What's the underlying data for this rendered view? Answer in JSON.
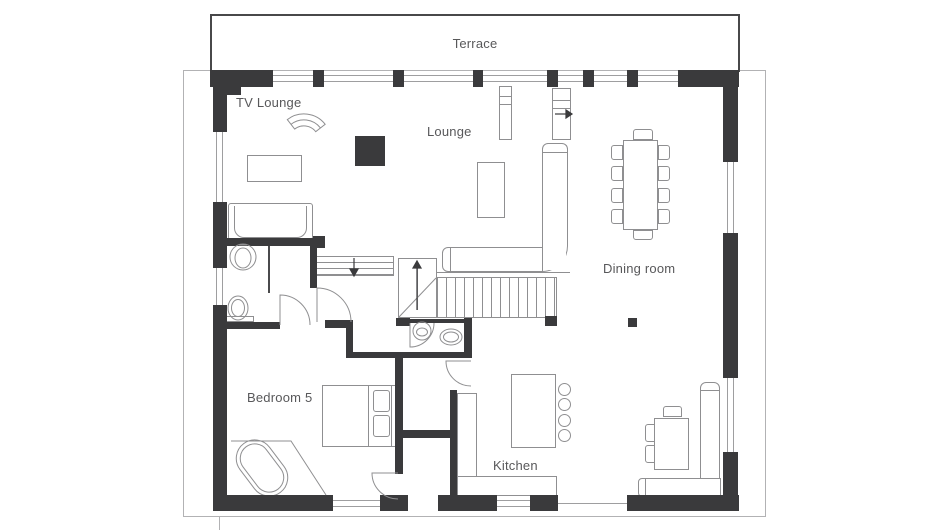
{
  "labels": {
    "terrace": "Terrace",
    "tv_lounge": "TV Lounge",
    "lounge": "Lounge",
    "dining_room": "Dining room",
    "bedroom_5": "Bedroom 5",
    "kitchen": "Kitchen"
  },
  "colors": {
    "wall": "#3a3a3c",
    "furniture_line": "#8f8f91",
    "boundary_line": "#b2b2b4",
    "label_text": "#58585a",
    "background": "#ffffff"
  },
  "stairs": {
    "main_stair_direction": "up",
    "lower_stair_direction": "down",
    "terrace_steps_direction": "right"
  }
}
